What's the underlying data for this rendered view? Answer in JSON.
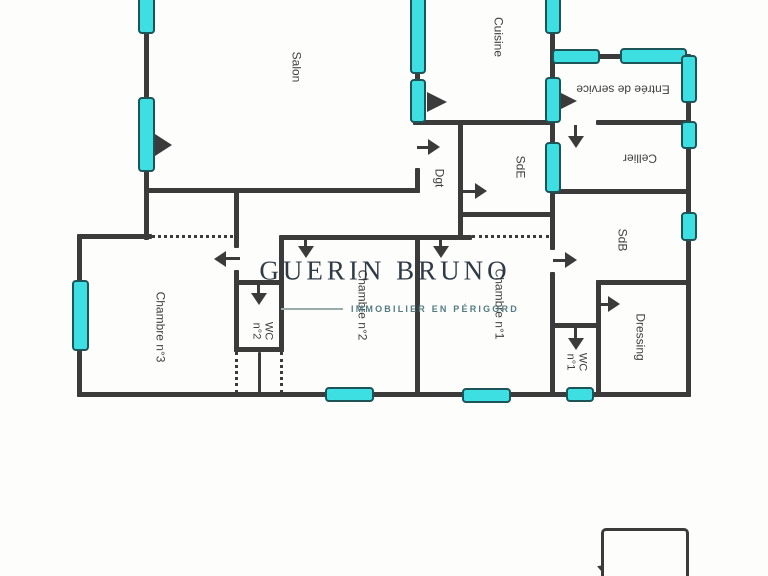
{
  "watermark": {
    "brand": "GUERIN BRUNO",
    "tagline": "IMMOBILIER EN PÉRIGORD"
  },
  "colors": {
    "wall": "#3b3b3b",
    "window_fill": "#3ddfe2",
    "window_stroke": "#1d5457",
    "label": "#3f3f3f",
    "brand": "#25313d",
    "tagline": "#527c80"
  },
  "plan": {
    "rooms": [
      {
        "id": "salon",
        "lines": [
          "Salon"
        ],
        "x": 296,
        "y": 67,
        "rot": 90,
        "size": 12
      },
      {
        "id": "cuisine",
        "lines": [
          "Cuisine"
        ],
        "x": 498,
        "y": 37,
        "rot": 90,
        "size": 12
      },
      {
        "id": "entree-de-service",
        "lines": [
          "Entrée de service"
        ],
        "x": 623,
        "y": 89,
        "rot": 180,
        "size": 12
      },
      {
        "id": "cellier",
        "lines": [
          "Cellier"
        ],
        "x": 640,
        "y": 158,
        "rot": 180,
        "size": 12
      },
      {
        "id": "sde",
        "lines": [
          "SdE"
        ],
        "x": 520,
        "y": 167,
        "rot": 90,
        "size": 12
      },
      {
        "id": "dgt",
        "lines": [
          "Dgt"
        ],
        "x": 439,
        "y": 178,
        "rot": 90,
        "size": 12
      },
      {
        "id": "sdb",
        "lines": [
          "SdB"
        ],
        "x": 622,
        "y": 240,
        "rot": 90,
        "size": 12
      },
      {
        "id": "chambre-1",
        "lines": [
          "Chambre n°1"
        ],
        "x": 499,
        "y": 304,
        "rot": 90,
        "size": 12
      },
      {
        "id": "chambre-2",
        "lines": [
          "Chambre n°2"
        ],
        "x": 362,
        "y": 305,
        "rot": 90,
        "size": 12
      },
      {
        "id": "chambre-3",
        "lines": [
          "Chambre n°3"
        ],
        "x": 160,
        "y": 327,
        "rot": 90,
        "size": 12
      },
      {
        "id": "wc-2",
        "lines": [
          "WC",
          "n°2"
        ],
        "x": 262,
        "y": 331,
        "rot": 90,
        "size": 11
      },
      {
        "id": "wc-1",
        "lines": [
          "WC",
          "n°1"
        ],
        "x": 576,
        "y": 362,
        "rot": 90,
        "size": 11
      },
      {
        "id": "dressing",
        "lines": [
          "Dressing"
        ],
        "x": 640,
        "y": 337,
        "rot": 90,
        "size": 12
      },
      {
        "id": "abri-jardin",
        "lines": [
          "Abri",
          "jardin"
        ],
        "x": 650,
        "y": 558,
        "rot": 90,
        "size": 11
      }
    ],
    "walls": [
      {
        "x": 144,
        "y": 0,
        "w": 5,
        "h": 240
      },
      {
        "x": 77,
        "y": 235,
        "w": 5,
        "h": 162
      },
      {
        "x": 415,
        "y": 0,
        "w": 5,
        "h": 125
      },
      {
        "x": 415,
        "y": 168,
        "w": 5,
        "h": 25
      },
      {
        "x": 550,
        "y": 0,
        "w": 5,
        "h": 250
      },
      {
        "x": 550,
        "y": 272,
        "w": 5,
        "h": 125
      },
      {
        "x": 686,
        "y": 55,
        "w": 5,
        "h": 342
      },
      {
        "x": 458,
        "y": 122,
        "w": 5,
        "h": 118
      },
      {
        "x": 415,
        "y": 237,
        "w": 5,
        "h": 158
      },
      {
        "x": 234,
        "y": 190,
        "w": 5,
        "h": 58
      },
      {
        "x": 234,
        "y": 270,
        "w": 5,
        "h": 82
      },
      {
        "x": 279,
        "y": 237,
        "w": 5,
        "h": 115
      },
      {
        "x": 258,
        "y": 352,
        "w": 3,
        "h": 43
      },
      {
        "x": 596,
        "y": 280,
        "w": 5,
        "h": 115
      },
      {
        "x": 144,
        "y": 188,
        "w": 276,
        "h": 5
      },
      {
        "x": 413,
        "y": 120,
        "w": 140,
        "h": 5
      },
      {
        "x": 550,
        "y": 54,
        "w": 141,
        "h": 5
      },
      {
        "x": 596,
        "y": 120,
        "w": 95,
        "h": 5
      },
      {
        "x": 550,
        "y": 189,
        "w": 141,
        "h": 5
      },
      {
        "x": 458,
        "y": 212,
        "w": 97,
        "h": 5
      },
      {
        "x": 77,
        "y": 234,
        "w": 75,
        "h": 5
      },
      {
        "x": 279,
        "y": 235,
        "w": 193,
        "h": 5
      },
      {
        "x": 234,
        "y": 280,
        "w": 50,
        "h": 5
      },
      {
        "x": 234,
        "y": 347,
        "w": 50,
        "h": 5
      },
      {
        "x": 550,
        "y": 323,
        "w": 51,
        "h": 5
      },
      {
        "x": 596,
        "y": 280,
        "w": 95,
        "h": 5
      },
      {
        "x": 77,
        "y": 392,
        "w": 614,
        "h": 5
      }
    ],
    "dotted": [
      {
        "o": "h",
        "x": 152,
        "y": 235,
        "len": 81
      },
      {
        "o": "h",
        "x": 472,
        "y": 235,
        "len": 77
      },
      {
        "o": "v",
        "x": 235,
        "y": 352,
        "len": 41
      },
      {
        "o": "v",
        "x": 280,
        "y": 352,
        "len": 41
      }
    ],
    "windows": [
      {
        "x": 138,
        "y": -4,
        "w": 17,
        "h": 38
      },
      {
        "x": 138,
        "y": 97,
        "w": 17,
        "h": 75
      },
      {
        "x": 72,
        "y": 280,
        "w": 17,
        "h": 71
      },
      {
        "x": 410,
        "y": -4,
        "w": 16,
        "h": 78
      },
      {
        "x": 410,
        "y": 79,
        "w": 16,
        "h": 44
      },
      {
        "x": 545,
        "y": -4,
        "w": 16,
        "h": 38
      },
      {
        "x": 545,
        "y": 77,
        "w": 16,
        "h": 46
      },
      {
        "x": 545,
        "y": 142,
        "w": 16,
        "h": 51
      },
      {
        "x": 552,
        "y": 49,
        "w": 48,
        "h": 15
      },
      {
        "x": 620,
        "y": 48,
        "w": 67,
        "h": 16
      },
      {
        "x": 681,
        "y": 55,
        "w": 16,
        "h": 48
      },
      {
        "x": 681,
        "y": 121,
        "w": 16,
        "h": 28
      },
      {
        "x": 681,
        "y": 212,
        "w": 16,
        "h": 29
      },
      {
        "x": 325,
        "y": 387,
        "w": 49,
        "h": 15
      },
      {
        "x": 462,
        "y": 388,
        "w": 49,
        "h": 15
      },
      {
        "x": 566,
        "y": 387,
        "w": 28,
        "h": 15
      }
    ],
    "arrows": [
      {
        "type": "tri",
        "x": 155,
        "y": 145,
        "w": 17,
        "h": 22,
        "rot": 0
      },
      {
        "type": "tri",
        "x": 427,
        "y": 102,
        "w": 20,
        "h": 20,
        "rot": 0
      },
      {
        "type": "tri",
        "x": 561,
        "y": 101,
        "w": 16,
        "h": 16,
        "rot": 0
      },
      {
        "type": "tri",
        "x": 601,
        "y": 568,
        "w": 16,
        "h": 18,
        "rot": -40
      },
      {
        "type": "arrow",
        "x": 417,
        "y": 147,
        "dir": "right",
        "len": 23
      },
      {
        "type": "arrow",
        "x": 462,
        "y": 191,
        "dir": "right",
        "len": 25
      },
      {
        "type": "arrow",
        "x": 576,
        "y": 125,
        "dir": "down",
        "len": 23
      },
      {
        "type": "arrow",
        "x": 553,
        "y": 260,
        "dir": "right",
        "len": 24
      },
      {
        "type": "arrow",
        "x": 598,
        "y": 304,
        "dir": "right",
        "len": 22
      },
      {
        "type": "arrow",
        "x": 576,
        "y": 328,
        "dir": "down",
        "len": 22
      },
      {
        "type": "arrow",
        "x": 306,
        "y": 237,
        "dir": "down",
        "len": 21
      },
      {
        "type": "arrow",
        "x": 441,
        "y": 237,
        "dir": "down",
        "len": 21
      },
      {
        "type": "arrow",
        "x": 259,
        "y": 283,
        "dir": "down",
        "len": 22
      },
      {
        "type": "arrow",
        "x": 240,
        "y": 259,
        "dir": "left",
        "len": 26
      }
    ]
  }
}
